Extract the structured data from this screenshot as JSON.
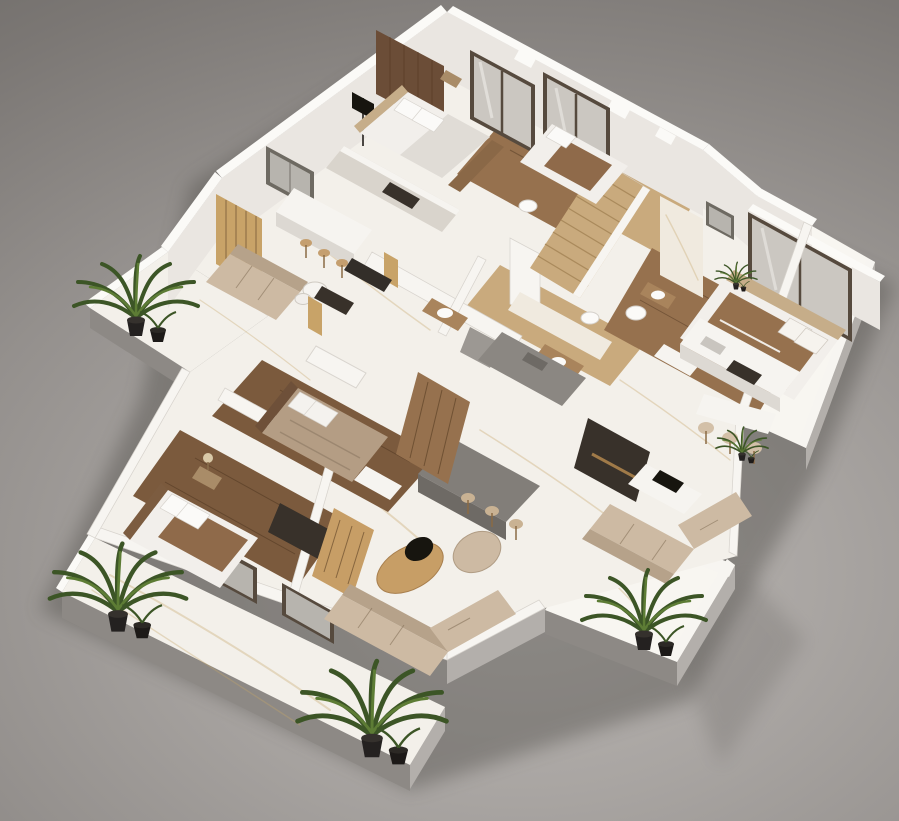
{
  "scene": {
    "type": "isometric-3d-floor-plan-render",
    "description": "Photorealistic cutaway 3D floor plan of an apartment seen from above at an angle on a neutral gray studio background. No text is rendered in the image.",
    "view": "isometric, rotated, lit from upper right",
    "text_content": "none"
  },
  "palette": {
    "bg_center": "#bbb7b4",
    "bg_edge": "#6d6a67",
    "ground_shadow": "#4a4643",
    "marble": "#f3f0ea",
    "marble_bright": "#f8f6f1",
    "vein": "#c7a569",
    "slab_side_dark": "#8d8985",
    "slab_side_light": "#b3afab",
    "wall_cap": "#fbfaf7",
    "wall_face": "#eae6e1",
    "wall_band": "#f7f5f1",
    "marble_wall": "#f0eadf",
    "wood_floor_dark": "#7b5a3d",
    "wood_floor_mid": "#96714e",
    "wood_floor_light": "#c9aa7d",
    "wood_accent": "#6b4d37",
    "oak": "#c79e66",
    "slat_gold": "#c8a368",
    "cabinet": "#d9d4cc",
    "counter_gray": "#8b8782",
    "island_gray": "#827e79",
    "island_side": "#6e6a65",
    "sofa_beige": "#cdbaa3",
    "sofa_back": "#b6a28a",
    "bed_taupe": "#b49d84",
    "blanket_brown": "#8f6a4a",
    "bedding_white": "#f2efeb",
    "white_soft": "#f6f4f0",
    "glass_frame": "#564a3e",
    "glass": "#cbc7c1",
    "window_frame": "#6e6a62",
    "window_glass": "#b7b4ae",
    "dark_unit": "#38312a",
    "black": "#17150f",
    "plant_dark": "#3c5526",
    "plant_light": "#5d7c35",
    "pot_black": "#242120"
  },
  "objects": {
    "rooms": [
      "master-bedroom",
      "bedroom-2",
      "bedroom-3",
      "bedroom-4",
      "family-living-room",
      "main-living-room",
      "kitchen-bar",
      "island-kitchen",
      "kitchenette",
      "bathroom-upper",
      "bathroom-central",
      "ensuite-bathroom",
      "walk-in-closet",
      "hallway",
      "staircase",
      "balcony-upper-left",
      "terrace-bottom-left",
      "balcony-right",
      "balcony-bottom-right"
    ],
    "furniture": [
      "bed-with-headboard-x4",
      "fabric-sofa-x3",
      "round-lounge-chair",
      "bar-counter-with-stools",
      "kitchen-island-with-stools",
      "dining-stools",
      "nesting-coffee-tables",
      "oval-coffee-table",
      "tv-console-x2",
      "slatted-media-bench",
      "wardrobe",
      "vanity-sink-x3",
      "toilet-x2",
      "cooktop-x2",
      "wall-tv",
      "palm-plant-x4",
      "small-potted-plant-x2",
      "bedside-lamp",
      "laptop"
    ]
  }
}
